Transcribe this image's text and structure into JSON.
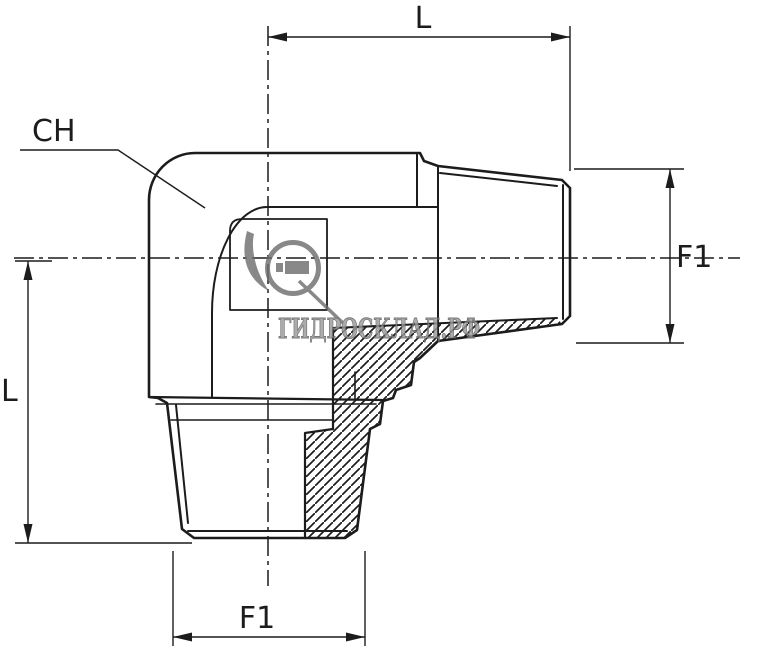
{
  "meta": {
    "type": "technical-drawing",
    "subject": "90-degree elbow fitting, male tapered threads both ends, partial section view"
  },
  "labels": {
    "length_top": "L",
    "length_left": "L",
    "thread_right": "F1",
    "thread_bottom": "F1",
    "hex": "CH"
  },
  "watermark": {
    "text": "ГИДРОСКЛАД.РФ"
  },
  "colors": {
    "line": "#1c1c1c",
    "background": "#ffffff",
    "watermark_fill": "#9a9a9a",
    "watermark_stroke": "#575757",
    "watermark_logo": "#6f6f6f"
  }
}
